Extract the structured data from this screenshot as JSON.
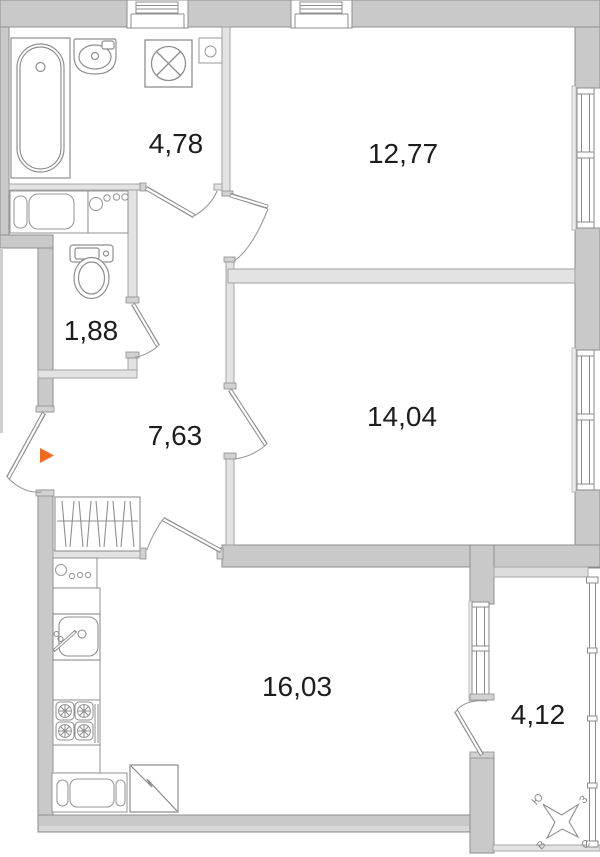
{
  "title": "apartment-floor-plan",
  "rooms": {
    "bathroom": {
      "name": "bathroom",
      "area": "4,78"
    },
    "bedroom_top": {
      "name": "bedroom-top",
      "area": "12,77"
    },
    "wc": {
      "name": "wc",
      "area": "1,88"
    },
    "hallway": {
      "name": "hallway",
      "area": "7,63"
    },
    "bedroom_right": {
      "name": "bedroom-right",
      "area": "14,04"
    },
    "kitchen": {
      "name": "kitchen-living",
      "area": "16,03"
    },
    "balcony": {
      "name": "balcony",
      "area": "4,12"
    }
  },
  "compass": {
    "south": "Ю",
    "west": "З",
    "east": "В",
    "north": "С"
  },
  "colors": {
    "wall_fill": "#c9c9ca",
    "partition_fill": "#e3e3e4",
    "outline": "#8e8e8e",
    "fixture_line": "#8f8f8f",
    "entry_arrow": "#f26a22",
    "label_text": "#1d1d1d"
  },
  "icons": {
    "bathtub-icon": "top-view bathtub",
    "washbasin-icon": "bathroom sink",
    "washing-machine-icon": "square with crossed drum circle",
    "vent-icon": "box with circle",
    "vent-shaft-icon": "white shaft block in top wall",
    "toilet-icon": "toilet with tank",
    "laundry-counter-icon": "counter with appliances",
    "knobs-counter-icon": "counter with one large and three small circles",
    "wardrobe-icon": "hatched closet",
    "entry-arrow-icon": "orange entrance triangle",
    "kitchen-sink-icon": "sink with faucet",
    "stove-icon": "four-burner stove",
    "fridge-icon": "square with lightning diagonal",
    "radiator-counter-icon": "counter with rounded modules",
    "window-icon": "double-line window with sill",
    "door-icon": "door leaf with swing arc",
    "compass-icon": "tilted four-point star"
  }
}
